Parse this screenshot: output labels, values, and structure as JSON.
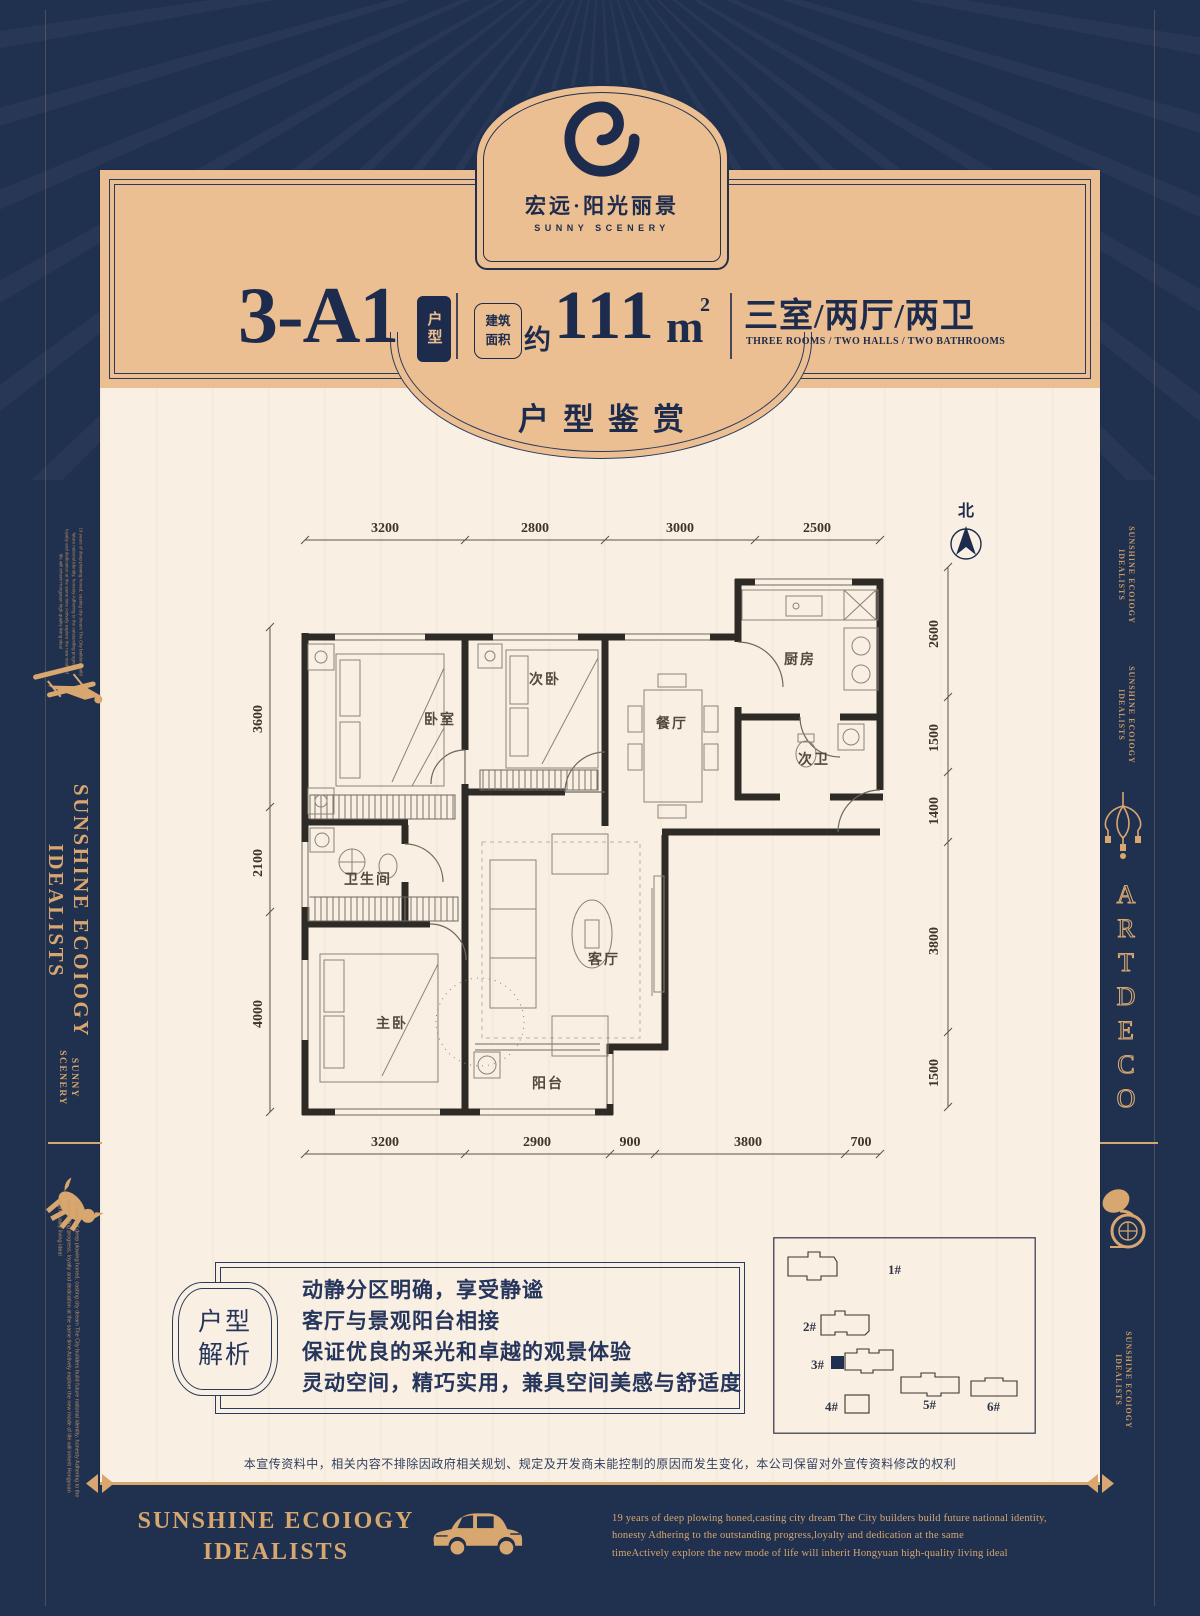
{
  "colors": {
    "navy": "#20304f",
    "tan": "#ecbf92",
    "gold": "#d8a76f",
    "cream": "#f9f0e3",
    "wall": "#2e2a25"
  },
  "brand": {
    "name_cn": "宏远·阳光丽景",
    "name_en": "SUNNY SCENERY"
  },
  "header": {
    "unit_code": "3-A1",
    "unit_tag": "户型",
    "area_tag_1": "建筑",
    "area_tag_2": "面积",
    "area_prefix": "约",
    "area_number": "111",
    "area_unit": "m",
    "area_sup": "2",
    "layout_cn": "三室/两厅/两卫",
    "layout_en": "THREE ROOMS / TWO HALLS / TWO BATHROOMS",
    "section_title": "户型鉴赏"
  },
  "floorplan": {
    "north": "北",
    "rooms": {
      "bedroom": "卧室",
      "second_bedroom": "次卧",
      "dining": "餐厅",
      "kitchen": "厨房",
      "second_bath": "次卫",
      "bathroom": "卫生间",
      "master_bedroom": "主卧",
      "living": "客厅",
      "balcony": "阳台"
    },
    "dims_top": [
      "3200",
      "2800",
      "3000",
      "2500"
    ],
    "dims_bottom": [
      "3200",
      "2900",
      "900",
      "3800",
      "700"
    ],
    "dims_left": [
      "3600",
      "2100",
      "4000"
    ],
    "dims_right": [
      "2600",
      "1500",
      "1400",
      "3800",
      "1500"
    ]
  },
  "analysis": {
    "badge_top": "户型",
    "badge_bottom": "解析",
    "lines": [
      "动静分区明确，享受静谧",
      "客厅与景观阳台相接",
      "保证优良的采光和卓越的观景体验",
      "灵动空间，精巧实用，兼具空间美感与舒适度"
    ]
  },
  "siteplan": {
    "building_labels": [
      "1#",
      "2#",
      "3#",
      "4#",
      "5#",
      "6#"
    ]
  },
  "disclaimer": "本宣传资料中，相关内容不排除因政府相关规划、规定及开发商未能控制的原因而发生变化，本公司保留对外宣传资料修改的权利",
  "footer": {
    "slogan_1": "SUNSHINE ECOIOGY",
    "slogan_2": "IDEALISTS",
    "desc_1": "19 years of deep plowing honed,casting city dream The City builders build future national identity,",
    "desc_2": "honesty Adhering to the outstanding progress,loyalty and dedication at the same",
    "desc_3": "timeActively explore the new mode of life will inherit  Hongyuan high-quality living ideal"
  },
  "sidebar": {
    "vertical_title": "SUNSHINE ECOIOGY IDEALISTS",
    "vertical_sub_1": "SUNNY",
    "vertical_sub_2": "SCENERY",
    "small_title_1": "SUNSHINE ECOIOGY",
    "small_title_2": "IDEALISTS",
    "artdeco": [
      "A",
      "R",
      "T",
      "D",
      "E",
      "C",
      "O"
    ],
    "micro_text": "19 years of deep plowing honed, casting city dream The City builders build future national identity, honesty Adhering to the outstanding progress, loyalty and dedication at the same time Actively explore the new mode of life will inherit Hongyuan high-quality living ideal"
  }
}
